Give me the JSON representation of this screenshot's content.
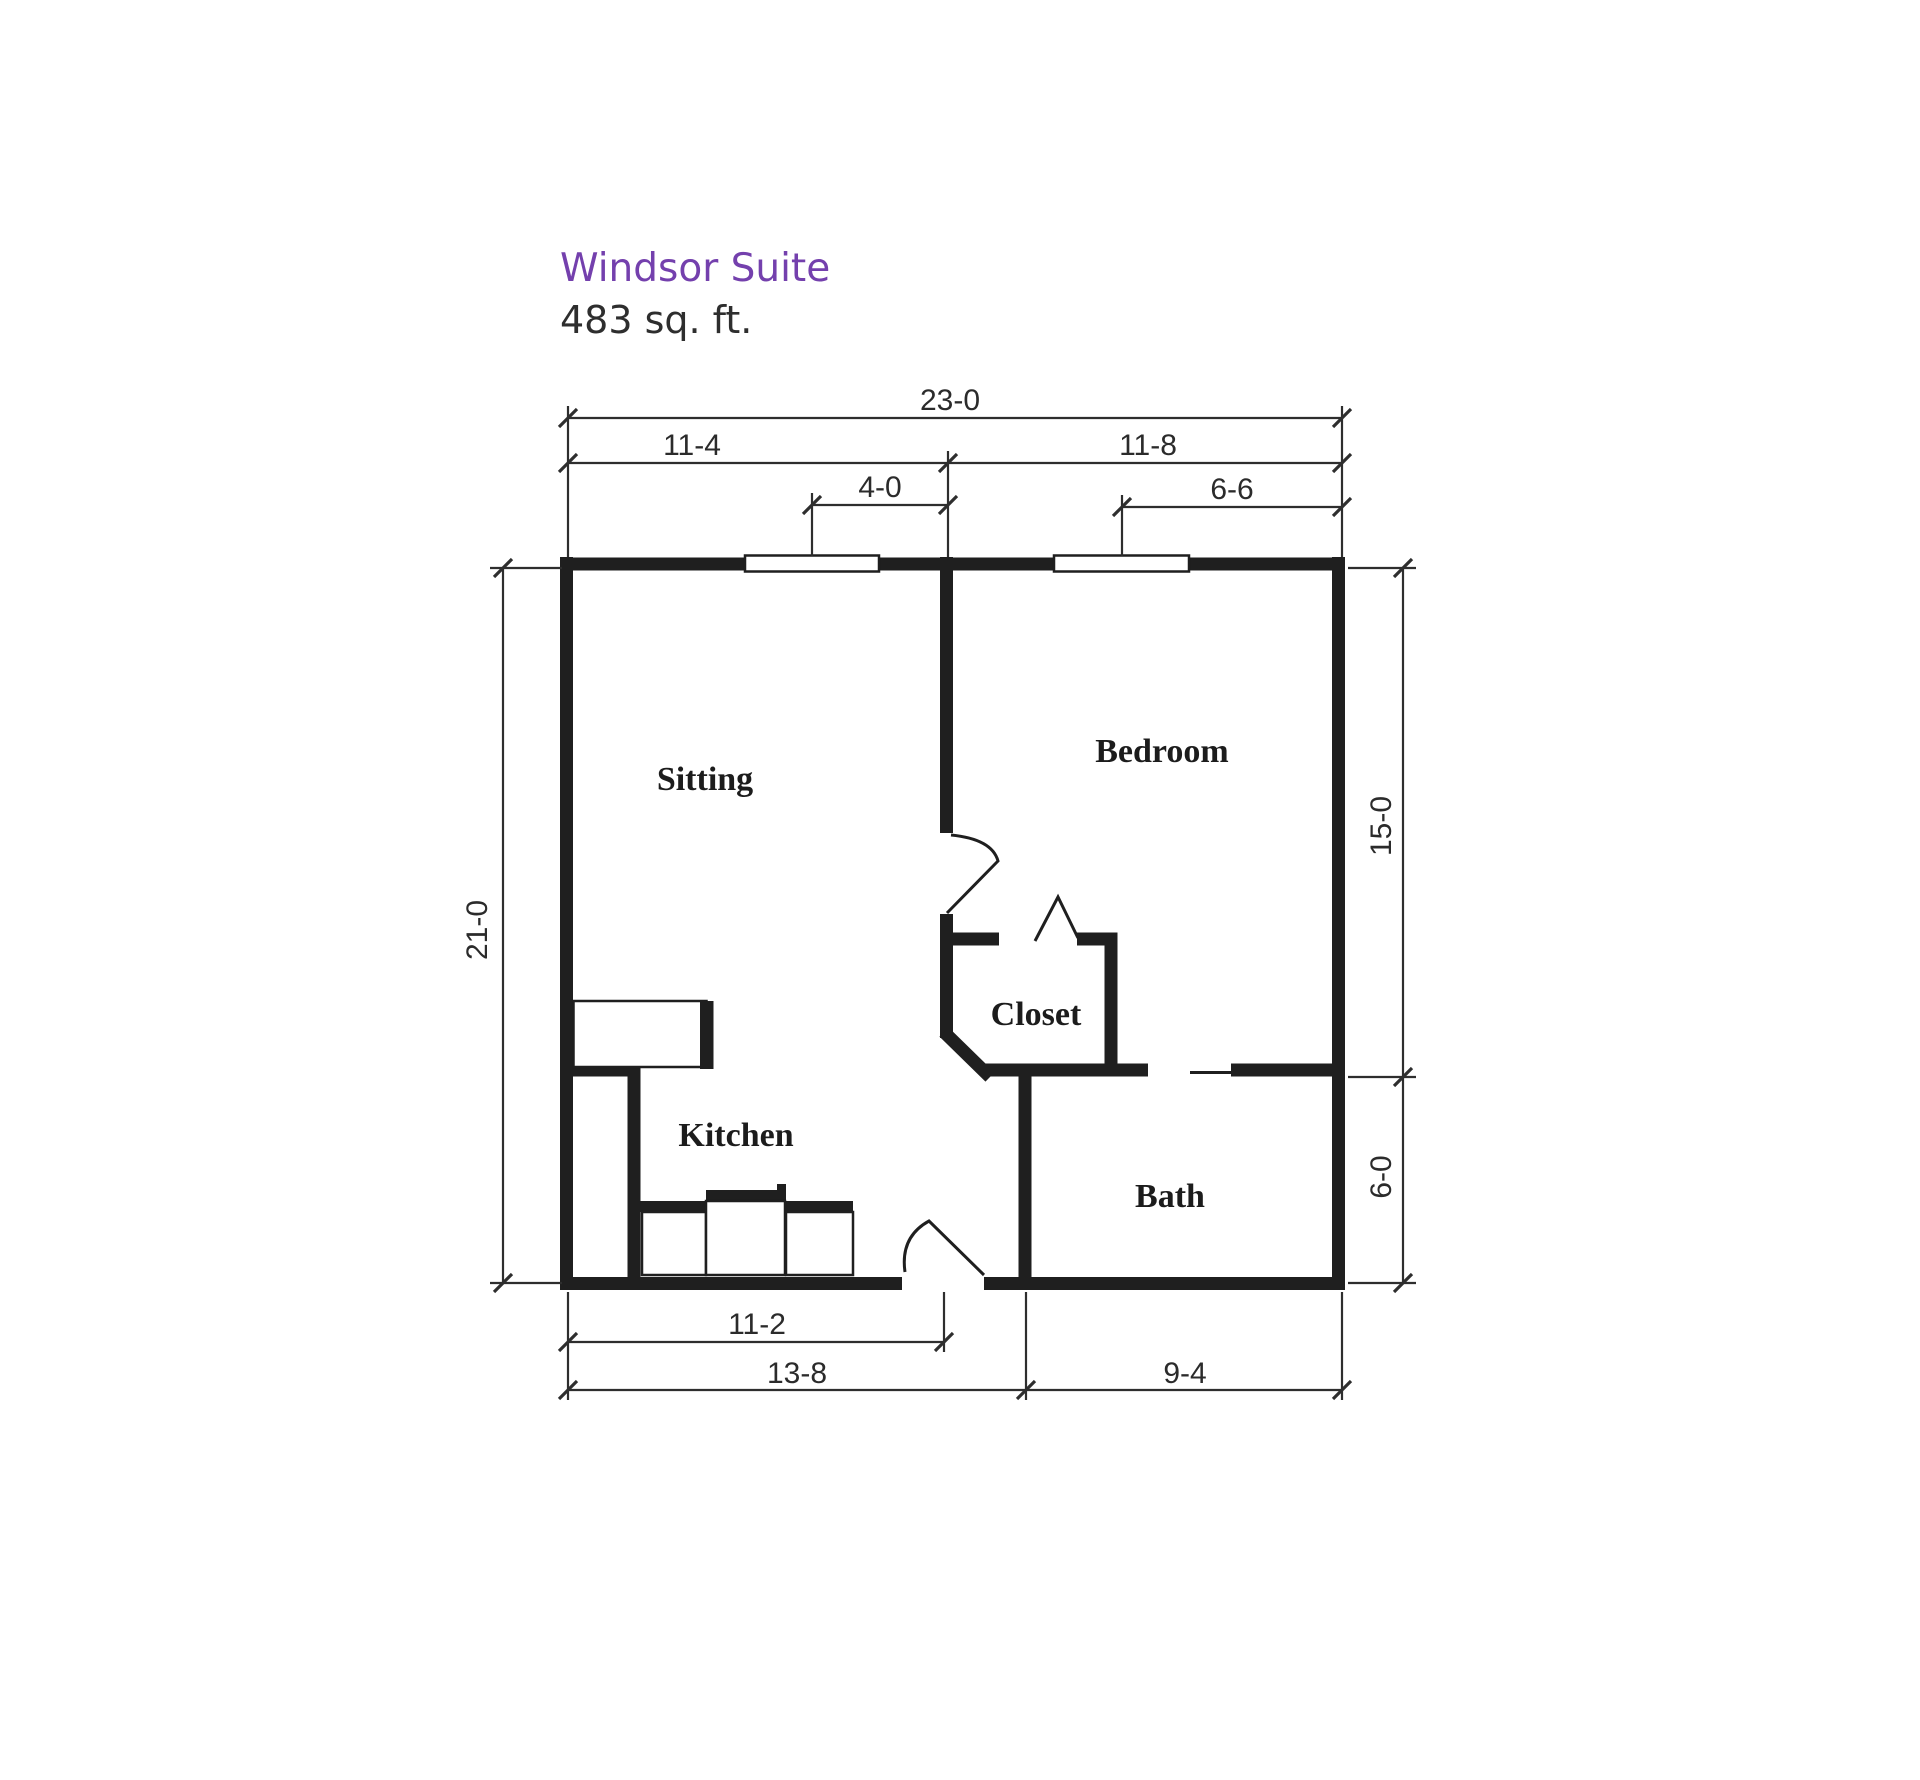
{
  "header": {
    "title": "Windsor Suite",
    "area": "483 sq. ft.",
    "title_color": "#7440ad",
    "text_color": "#2e2e2e"
  },
  "floor_plan": {
    "rooms": {
      "sitting": "Sitting",
      "bedroom": "Bedroom",
      "kitchen": "Kitchen",
      "closet": "Closet",
      "bath": "Bath"
    },
    "dimensions": {
      "overall_width": "23-0",
      "sitting_width": "11-4",
      "bedroom_width": "11-8",
      "sitting_window": "4-0",
      "bedroom_window": "6-6",
      "overall_depth": "21-0",
      "bedroom_depth": "15-0",
      "bath_depth": "6-0",
      "entry_offset": "11-2",
      "kitchen_width": "13-8",
      "bath_width": "9-4"
    },
    "wall_color": "#1f1f1f",
    "line_color": "#2e2e2e"
  }
}
